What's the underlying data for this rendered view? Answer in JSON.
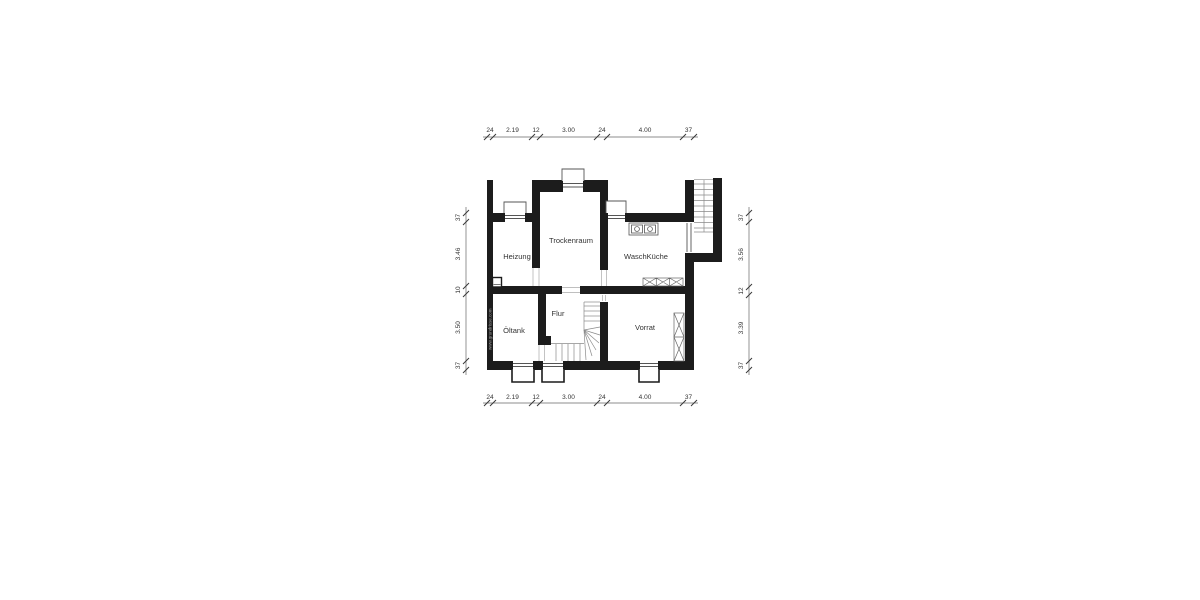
{
  "plan": {
    "rooms": {
      "heizung": "Heizung",
      "trockenraum": "Trockenraum",
      "waschkueche": "WaschKüche",
      "oeltank": "Öltank",
      "flur": "Flur",
      "vorrat": "Vorrat"
    },
    "dims": {
      "top": [
        "24",
        "2.19",
        "12",
        "3.00",
        "24",
        "4.00",
        "37"
      ],
      "bottom": [
        "24",
        "2.19",
        "12",
        "3.00",
        "24",
        "4.00",
        "37"
      ],
      "left": [
        "37",
        "3.46",
        "10",
        "3.50",
        "37"
      ],
      "right": [
        "37",
        "3.56",
        "12",
        "3.39",
        "37"
      ]
    },
    "watermark": "www.grundrisse.com",
    "colors": {
      "wall": "#1c1c1c",
      "background": "#ffffff",
      "dimension_text": "#333333",
      "thin_lines": "#8a8a8a"
    }
  }
}
